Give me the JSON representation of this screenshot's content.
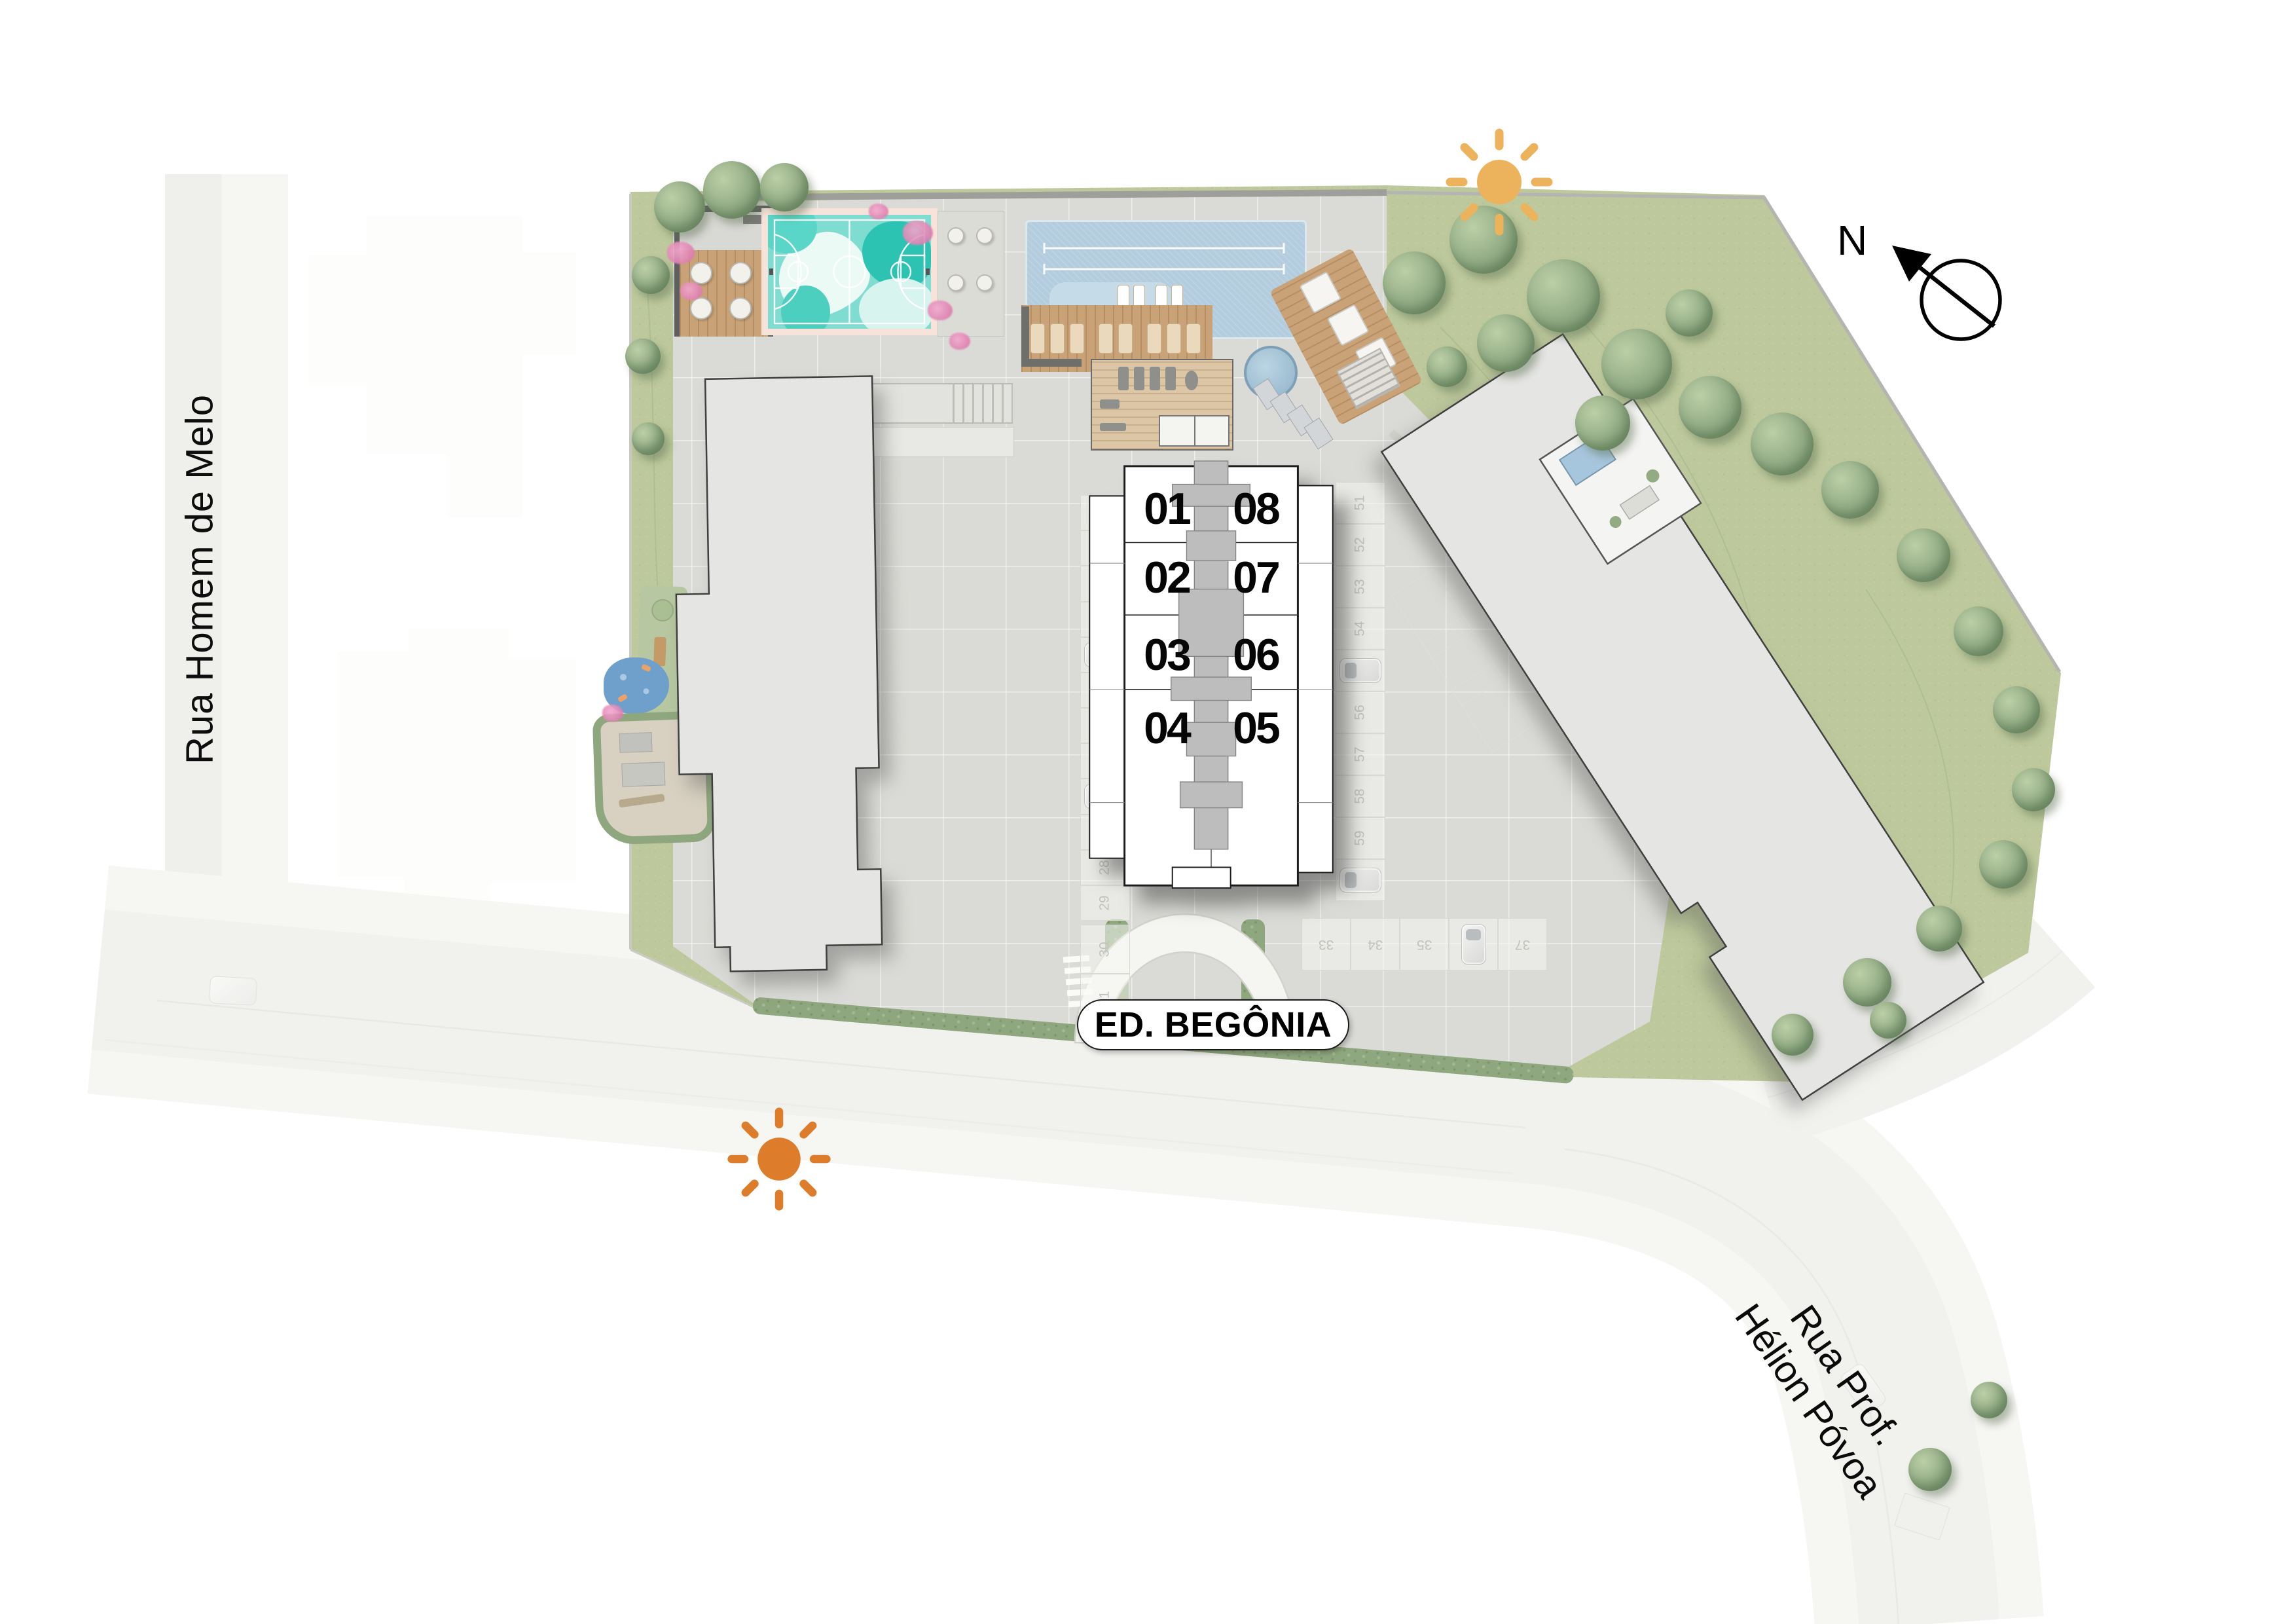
{
  "building_label": "ED. BEGÔNIA",
  "streets": {
    "left": "Rua Homem de Melo",
    "bottom_right_line1": "Rua Prof.",
    "bottom_right_line2": "Hélion Póvoa"
  },
  "compass": {
    "north_label": "N"
  },
  "key_plan": {
    "rows": [
      {
        "left": "01",
        "right": "08"
      },
      {
        "left": "02",
        "right": "07"
      },
      {
        "left": "03",
        "right": "06"
      },
      {
        "left": "04",
        "right": "05"
      }
    ]
  },
  "parking": {
    "left_column": [
      {
        "label": "18"
      },
      {
        "label": "19"
      },
      {
        "label": "20"
      },
      {
        "label": "21"
      },
      {
        "label": "22",
        "car": true
      },
      {
        "label": "23"
      },
      {
        "label": "24"
      },
      {
        "label": "25"
      },
      {
        "label": "",
        "car": true
      },
      {
        "label": "27"
      },
      {
        "label": "28"
      },
      {
        "label": "29"
      }
    ],
    "right_column": [
      {
        "label": "51"
      },
      {
        "label": "52"
      },
      {
        "label": "53"
      },
      {
        "label": "54"
      },
      {
        "label": "",
        "car": true
      },
      {
        "label": "56"
      },
      {
        "label": "57"
      },
      {
        "label": "58"
      },
      {
        "label": "59"
      },
      {
        "label": "",
        "car": true
      }
    ],
    "bottom_row": [
      {
        "label": "33"
      },
      {
        "label": "34"
      },
      {
        "label": "35"
      },
      {
        "label": "",
        "car": true
      },
      {
        "label": "37"
      }
    ],
    "bottom_left": [
      {
        "label": "30"
      },
      {
        "label": "31"
      }
    ]
  },
  "colors": {
    "sun_top": "#ECB25C",
    "sun_bottom": "#DD7C2B",
    "grass": "#BDC99C",
    "court_teal": "#7FDCD0",
    "court_border": "#F7E3DA",
    "pool_blue": "#B3CDDF",
    "paving": "#DADBD6",
    "building_gray": "#E5E5E3"
  }
}
